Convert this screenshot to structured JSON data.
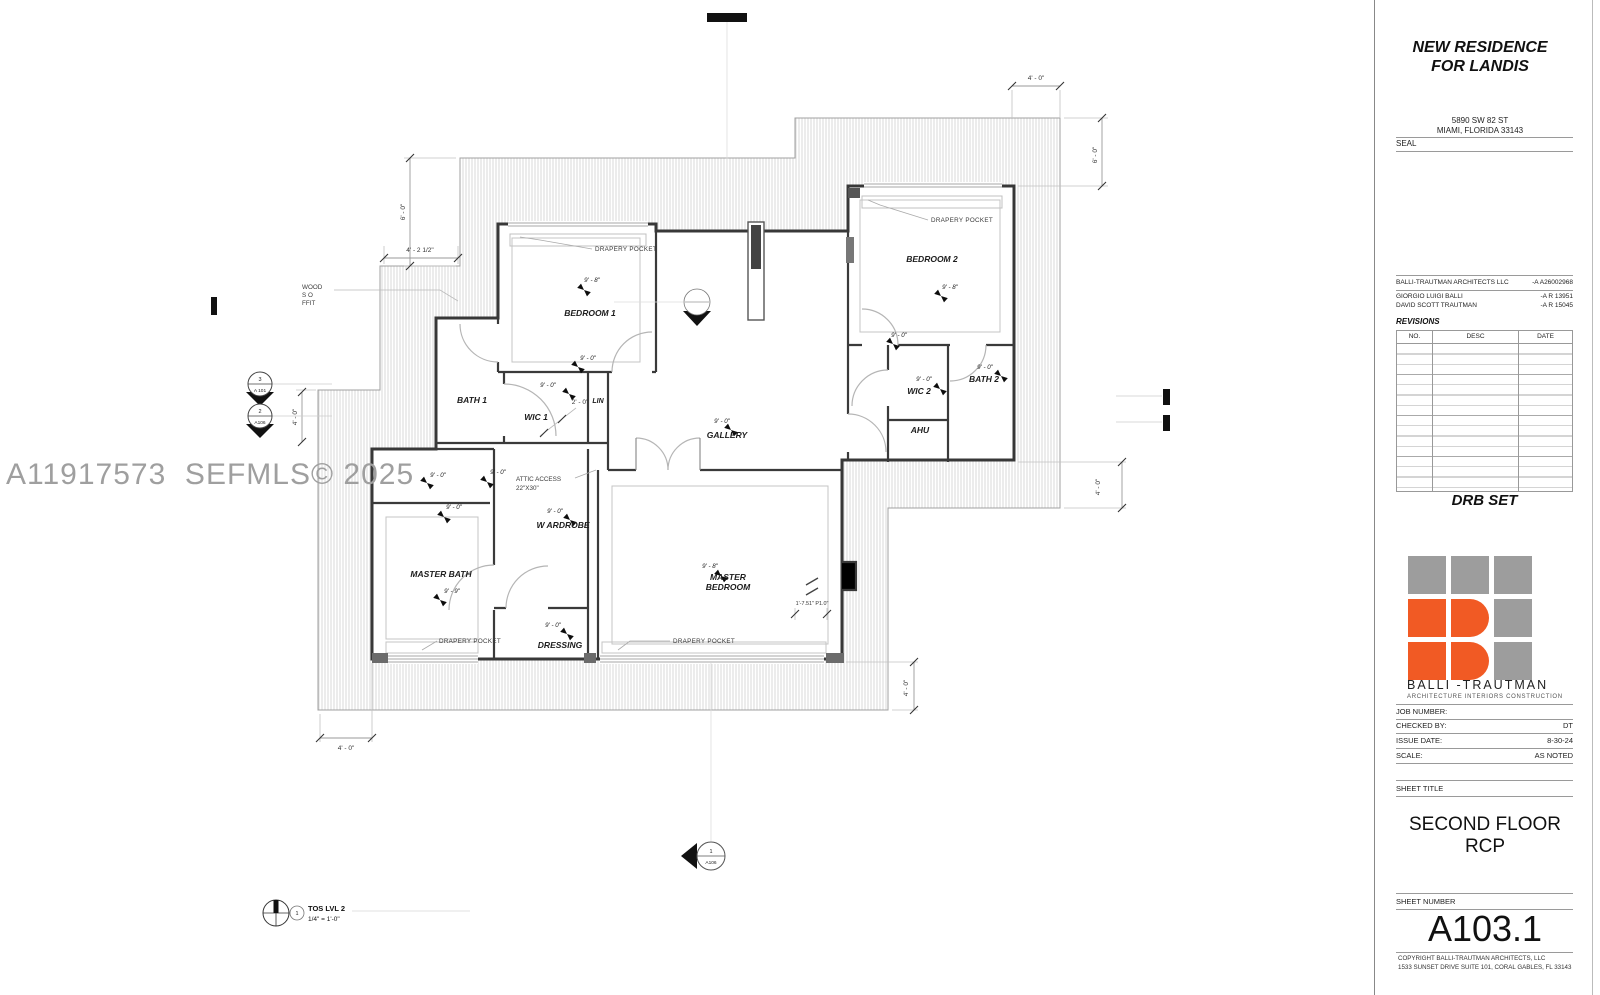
{
  "watermark": "A11917573  SEFMLS© 2025",
  "titleblock": {
    "project_title_line1": "NEW RESIDENCE",
    "project_title_line2": "FOR LANDIS",
    "address_line1": "5890 SW 82 ST",
    "address_line2": "MIAMI, FLORIDA 33143",
    "seal_label": "SEAL",
    "firm_name": "BALLI-TRAUTMAN ARCHITECTS LLC",
    "firm_license": "-A A26002968",
    "architect1_name": "GIORGIO LUIGI BALLI",
    "architect1_license": "-A R 13951",
    "architect2_name": "DAVID SCOTT TRAUTMAN",
    "architect2_license": "-A R 15045",
    "revisions": {
      "title": "REVISIONS",
      "col_no": "NO.",
      "col_desc": "DESC",
      "col_date": "DATE"
    },
    "set_label": "DRB SET",
    "logo_name": "BALLI -TRAUTMAN",
    "logo_tagline": "ARCHITECTURE  INTERIORS   CONSTRUCTION",
    "job_number_label": "JOB NUMBER:",
    "job_number_value": "",
    "checked_by_label": "CHECKED BY:",
    "checked_by_value": "DT",
    "issue_date_label": "ISSUE   DATE:",
    "issue_date_value": "8-30-24",
    "scale_label": "SCALE:",
    "scale_value": "AS NOTED",
    "sheet_title_label": "SHEET TITLE",
    "sheet_title_line1": "SECOND FLOOR",
    "sheet_title_line2": "RCP",
    "sheet_number_label": "SHEET NUMBER",
    "sheet_number": "A103.1",
    "copyright_line1": "COPYRIGHT BALLI-TRAUTMAN ARCHITECTS, LLC",
    "copyright_line2": "1533 SUNSET DRIVE SUITE 101, CORAL GABLES, FL 33143"
  },
  "plan": {
    "labels": {
      "bedroom1": "BEDROOM 1",
      "bedroom2": "BEDROOM 2",
      "bath1": "BATH 1",
      "wic1": "WIC 1",
      "lin": "LIN",
      "gallery": "GALLERY",
      "wic2": "WIC 2",
      "bath2": "BATH 2",
      "ahu": "AHU",
      "master_bath": "MASTER BATH",
      "wardrobe": "W ARDROBE",
      "master_l1": "MASTER",
      "master_l2": "BEDROOM",
      "dressing": "DRESSING"
    },
    "heights": {
      "h98": "9' - 8\"",
      "h90": "9' - 0\"",
      "h99": "9' - 9\""
    },
    "dims": {
      "d40": "4' - 0\"",
      "d60": "6' - 0\"",
      "d4212": "4' - 2 1/2\"",
      "d20": "2' - 0\"",
      "mbr": "1'-7.51\" P1.0\""
    },
    "notes": {
      "drapery": "DRAPERY POCKET",
      "attic1": "ATTIC ACCESS",
      "attic2": "22\"X30\"",
      "wood1": "WOOD",
      "wood2": "S    O",
      "wood3": "FFIT"
    },
    "markers": {
      "m3": {
        "num": "3",
        "sheet": "A 101"
      },
      "m2": {
        "num": "2",
        "sheet": "A106"
      },
      "m1": {
        "num": "1",
        "sheet": "A106"
      }
    },
    "legend": {
      "num": "1",
      "name": "TOS LVL 2",
      "scale": "1/4\" = 1'-0\""
    }
  }
}
